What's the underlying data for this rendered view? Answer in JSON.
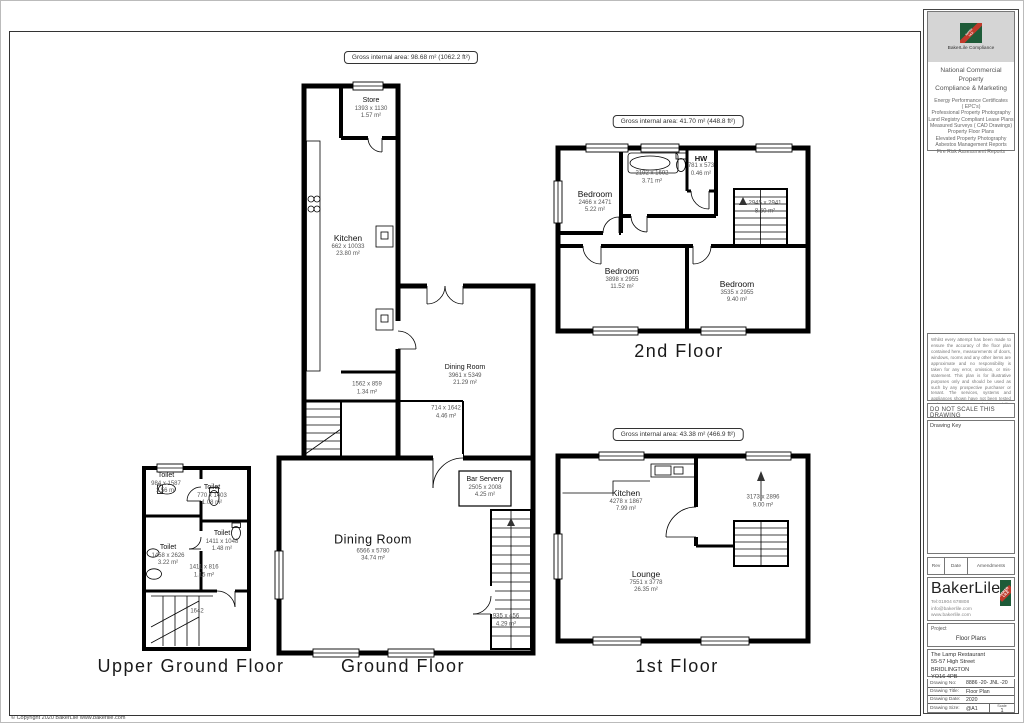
{
  "sheet": {
    "copyright": "© Copyright 2020 BakerLile   www.bakerlile.com"
  },
  "floors": {
    "ground": {
      "title": "Ground Floor",
      "gross": "Gross internal area: 98.68 m² (1062.2 ft²)",
      "rooms": {
        "store": {
          "name": "Store",
          "dims": "1393 x 1130",
          "area": "1.57 m²"
        },
        "kitchen": {
          "name": "Kitchen",
          "dims": "662 x 10033",
          "area": "23.80 m²"
        },
        "dining_upper": {
          "name": "Dining Room",
          "dims": "3961 x 5349",
          "area": "21.29 m²"
        },
        "lobby": {
          "dims": "1562 x 859",
          "area": "1.34 m²"
        },
        "stair_hall": {
          "dims": "714 x 1642",
          "area": "4.46 m²"
        },
        "dining_main": {
          "name": "Dining Room",
          "dims": "6566 x 5780",
          "area": "34.74 m²"
        },
        "bar": {
          "name": "Bar Servery",
          "dims": "2505 x 2008",
          "area": "4.25 m²"
        },
        "stair_lobby": {
          "dims": "935 x 456",
          "area": "4.29 m²"
        }
      }
    },
    "upper_ground": {
      "title": "Upper Ground Floor",
      "rooms": {
        "toilet1": {
          "name": "Toilet",
          "dims": "984 x 1587",
          "area": "1.56 m²"
        },
        "toilet2": {
          "name": "Toilet",
          "dims": "770 x 1403",
          "area": "1.08 m²"
        },
        "toilet3": {
          "name": "Toilet",
          "dims": "1411 x 1048",
          "area": "1.48 m²"
        },
        "toilet4": {
          "name": "Toilet",
          "dims": "1458 x 2626",
          "area": "3.22 m²"
        },
        "corridor": {
          "dims": "1411 x 816",
          "area": "1.15 m²"
        },
        "stair": {
          "dims": "1642"
        }
      }
    },
    "second": {
      "title": "2nd Floor",
      "gross": "Gross internal area: 41.70 m² (448.8 ft²)",
      "rooms": {
        "bedroom1": {
          "name": "Bedroom",
          "dims": "2466 x 2471",
          "area": "5.22 m²"
        },
        "bathroom": {
          "dims": "2192 x 1692",
          "area": "3.71 m²"
        },
        "hw": {
          "name": "HW",
          "dims": "781 x 573",
          "area": "0.46 m²"
        },
        "stairs": {
          "dims": "2945 x 2941",
          "area": "8.50 m²"
        },
        "bedroom2": {
          "name": "Bedroom",
          "dims": "3898 x 2955",
          "area": "11.52 m²"
        },
        "bedroom3": {
          "name": "Bedroom",
          "dims": "3535 x 2955",
          "area": "9.40 m²"
        }
      }
    },
    "first": {
      "title": "1st Floor",
      "gross": "Gross internal area: 43.38 m² (466.9 ft²)",
      "rooms": {
        "kitchen": {
          "name": "Kitchen",
          "dims": "4278 x 1867",
          "area": "7.99 m²"
        },
        "stair_hall": {
          "dims": "3173 x 2896",
          "area": "9.00 m²"
        },
        "lounge": {
          "name": "Lounge",
          "dims": "7551 x 3778",
          "area": "26.35 m²"
        }
      }
    }
  },
  "sidebar": {
    "compliance": {
      "caption": "BakerLile Compliance",
      "heading_line1": "National Commercial Property",
      "heading_line2": "Compliance & Marketing",
      "services": [
        "Energy Performance Certificates",
        "( EPC's)",
        "Professional Property Photography",
        "Land Registry Compliant Lease Plans",
        "Measured Surveys ( CAD Drawings)",
        "Property Floor Plans",
        "Elevated Property Photography",
        "Asbestos Management Reports",
        "Fire Risk Assessment Reports"
      ]
    },
    "disclaimer": "Whilst every attempt has been made to ensure the accuracy of the floor plan contained here, measurements of doors, windows, rooms and any other items are approximate and no responsibility is taken for any error, omission, or mis-statement. This plan is for illustrative purposes only and should be used as such by any prospective purchaser or tenant. The services, systems and appliances shown have not been tested and no guarantee as to their operability or efficiency can be given.",
    "do_not_scale": "DO NOT SCALE THIS DRAWING",
    "drawing_key": "Drawing Key",
    "rev_table": {
      "col1": "Rev",
      "col2": "Date",
      "col3": "Amendments"
    },
    "brand": {
      "name": "BakerLile",
      "tel": "Tel:01904 678808",
      "email": "info@bakerlile.com",
      "web": "www.bakerlile.com",
      "logo_top": "BAKER",
      "logo_bottom": "LILE",
      "logo_green": "#1e5b38",
      "logo_red": "#c03a2b"
    },
    "project": {
      "label": "Project",
      "value": "Floor Plans"
    },
    "address": [
      "The Lamp Restaurant",
      "55-57 High Street",
      "BRIDLINGTON",
      "YO16 4PB"
    ],
    "info": {
      "rows": [
        {
          "label": "Drawing No:",
          "value": "8886 -20- JNL -20"
        },
        {
          "label": "Drawing Title:",
          "value": "Floor Plan"
        },
        {
          "label": "Drawing Date:",
          "value": "2020"
        },
        {
          "label": "Drawing Size:",
          "value": "@A1"
        }
      ],
      "scale_label": "Scale",
      "scale_value": "1"
    }
  }
}
